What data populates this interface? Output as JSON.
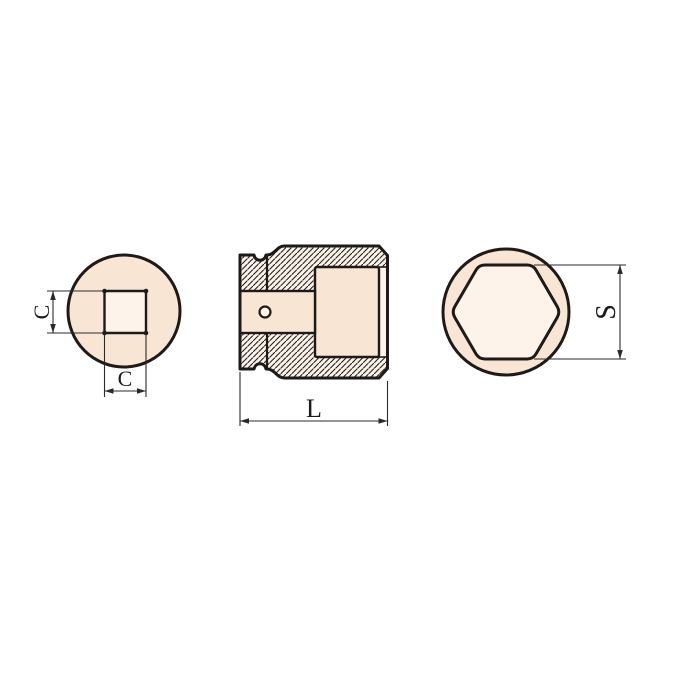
{
  "page": {
    "background": "#ffffff"
  },
  "drawing": {
    "description": "Three-view technical drawing of a square-drive impact socket",
    "colors": {
      "body_fill": "#f9e5d4",
      "inner_fill": "#fdf3ea",
      "outline": "#1d1a17",
      "dimension_line": "#2a2a2a",
      "background": "#ffffff"
    },
    "views": {
      "square_drive_end": {
        "name": "square drive end view",
        "dim_height_label": "C",
        "dim_width_label": "C"
      },
      "section": {
        "name": "sectional side view",
        "dim_length_label": "L"
      },
      "hex_socket_end": {
        "name": "hex socket end view",
        "dim_across_flats_label": "S"
      }
    }
  }
}
